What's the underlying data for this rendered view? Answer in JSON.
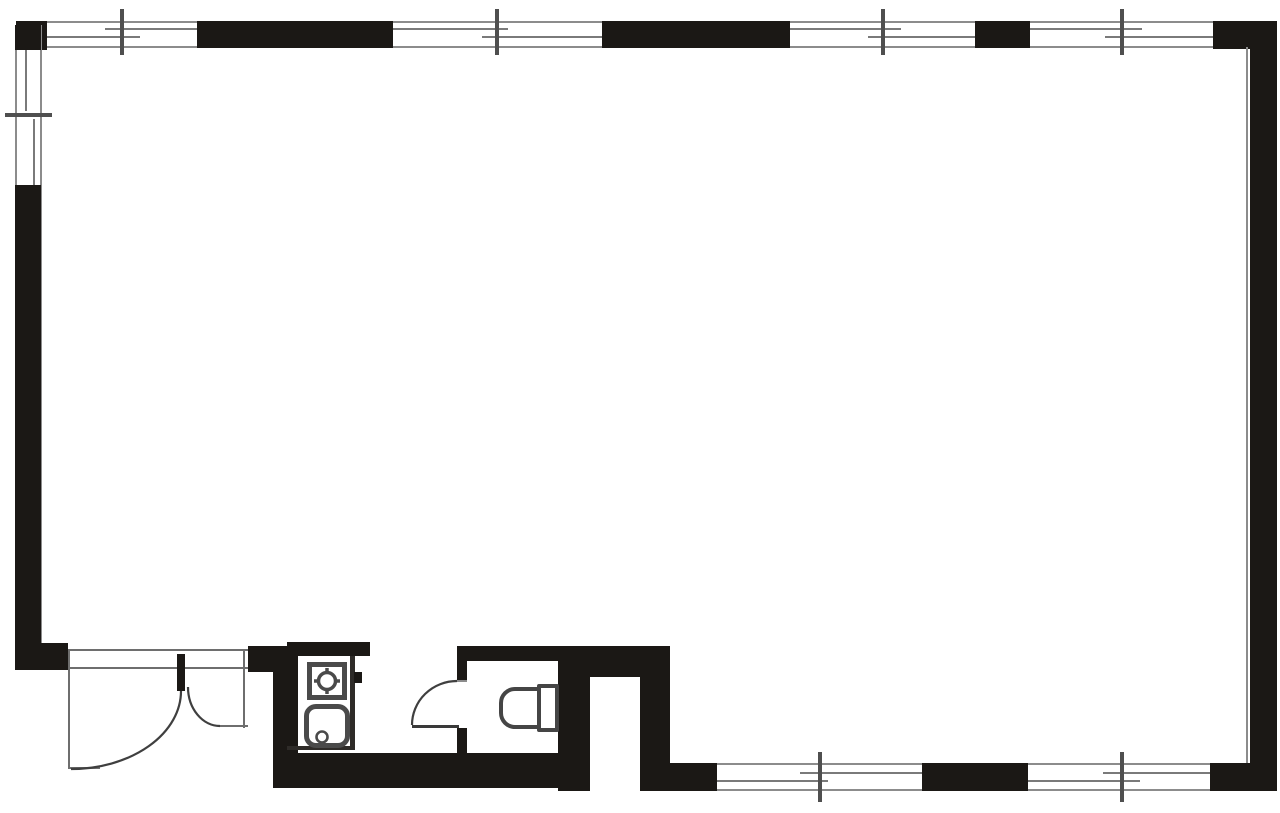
{
  "meta": {
    "diagram_type": "architectural-floor-plan",
    "description": "Black and white floor plan of a large open rectangular room with perimeter sliding windows, a recessed double-door entrance at lower left, a small kitchenette sink unit, a toilet room, and an exterior service recess in the bottom wall.",
    "visible_text": []
  },
  "colors": {
    "background": "#ffffff",
    "wall": "#1b1815",
    "window_frame_line": "#8c8c8c",
    "sash_line": "#7a7a7a",
    "tick": "#4f4f4f",
    "thin_line": "#6e6e6e",
    "fixture_outline": "#4a4a4a"
  },
  "elements": {
    "windows": {
      "top_wall_count": 4,
      "left_wall_count": 1,
      "bottom_wall_count": 2,
      "symbol": "double-line sliding window with center mullion tick"
    },
    "doors": [
      {
        "name": "entrance-double-door",
        "type": "double-leaf swing, unequal leaves",
        "location": "bottom-left porch"
      },
      {
        "name": "toilet-door",
        "type": "single swing outward",
        "location": "toilet room left wall"
      }
    ],
    "fixtures": [
      {
        "name": "kitchenette-sink-unit",
        "parts": [
          "burner-or-faucet-circle",
          "faucet-knob",
          "sink-basin-with-drain"
        ]
      },
      {
        "name": "toilet",
        "parts": [
          "tank",
          "bowl"
        ]
      }
    ],
    "rooms": [
      {
        "name": "main-room"
      },
      {
        "name": "entrance-porch"
      },
      {
        "name": "kitchenette-nook"
      },
      {
        "name": "toilet-room"
      },
      {
        "name": "exterior-recess"
      }
    ]
  }
}
